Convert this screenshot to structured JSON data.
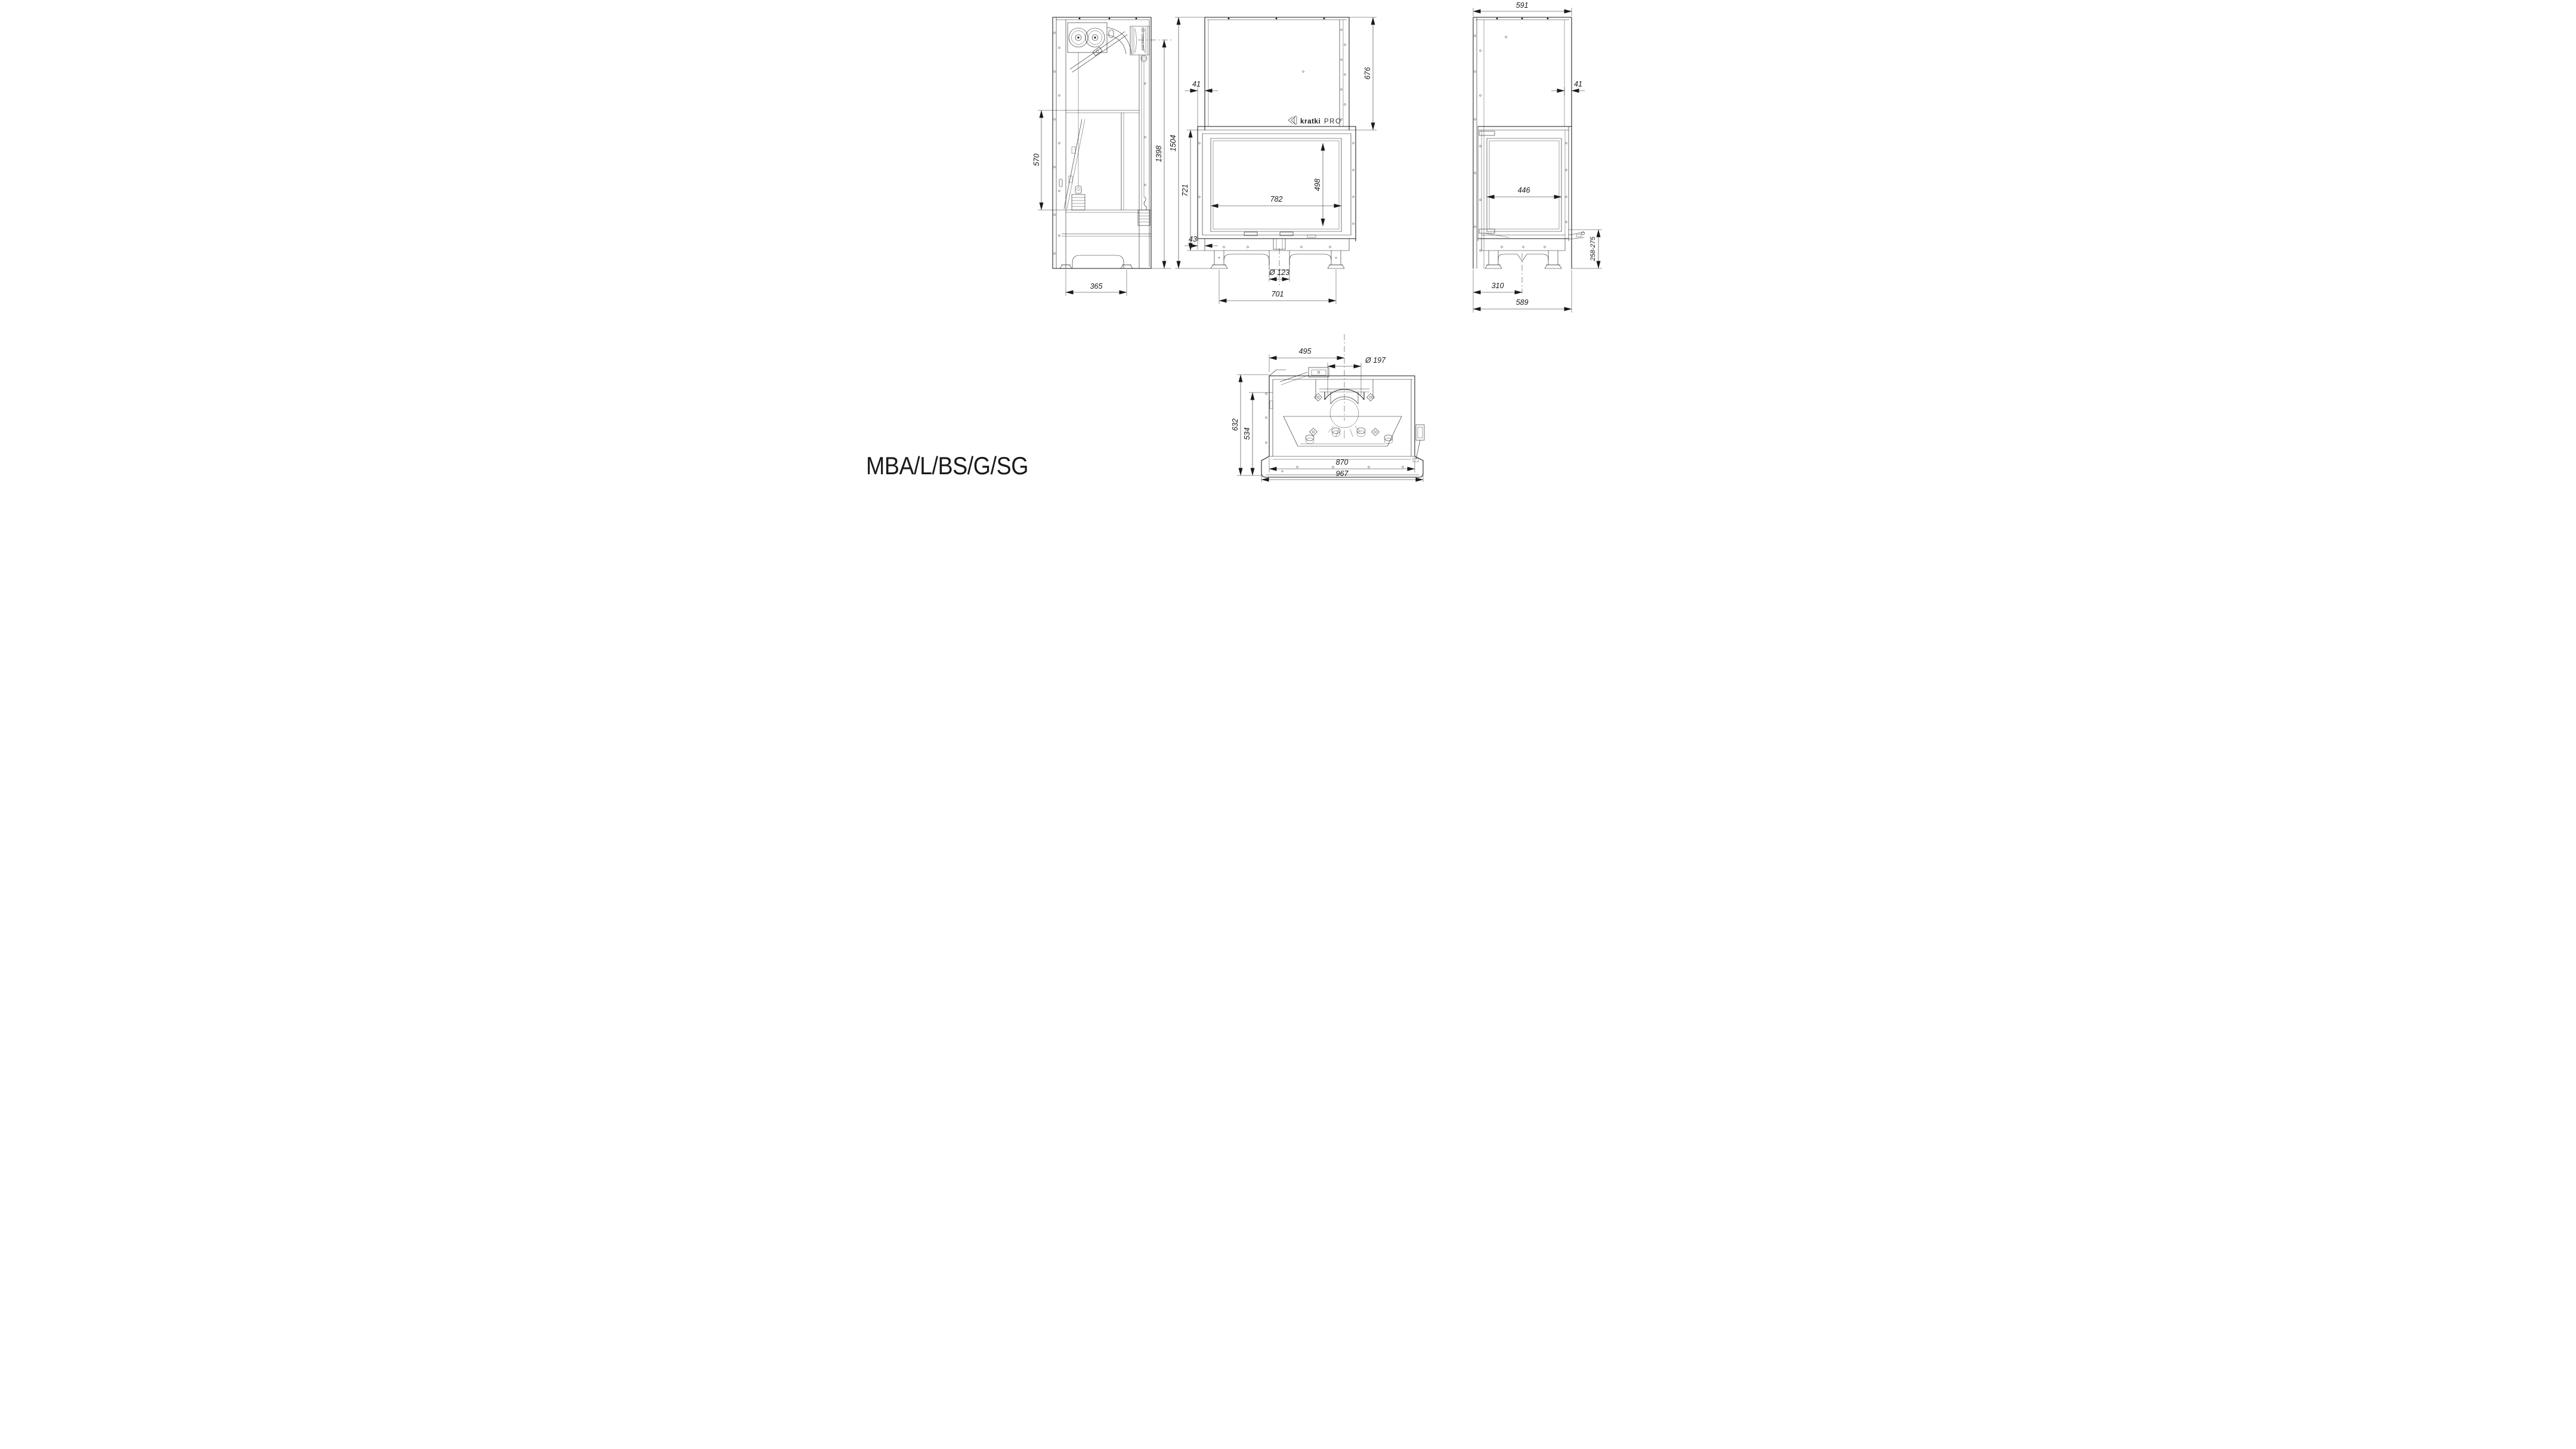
{
  "colors": {
    "background": "#ffffff",
    "ink": "#1a1a1a"
  },
  "model_label": "MBA/L/BS/G/SG",
  "brand_logo": {
    "name": "kratki",
    "suffix": "PRO"
  },
  "side_view": {
    "part_label": "ND-10201/200",
    "dims": {
      "inner_height": "570",
      "flue_height": "1398",
      "base_width": "365"
    }
  },
  "front_view": {
    "dims": {
      "top_offset": "41",
      "hood_height": "676",
      "total_height": "1504",
      "body_height": "721",
      "bottom_offset": "43",
      "glass_width": "782",
      "glass_height": "498",
      "air_inlet_diameter": "Ø 123",
      "base_width": "701"
    }
  },
  "right_view": {
    "dims": {
      "top_depth": "591",
      "rear_offset": "41",
      "glass_width": "446",
      "base_height_range": "258-275",
      "flue_center_offset": "310",
      "base_depth": "589"
    }
  },
  "bottom_view": {
    "dims": {
      "flue_center_from_front": "495",
      "flue_diameter": "Ø 197",
      "total_depth": "632",
      "body_depth": "534",
      "body_width": "870",
      "total_width": "967"
    }
  }
}
